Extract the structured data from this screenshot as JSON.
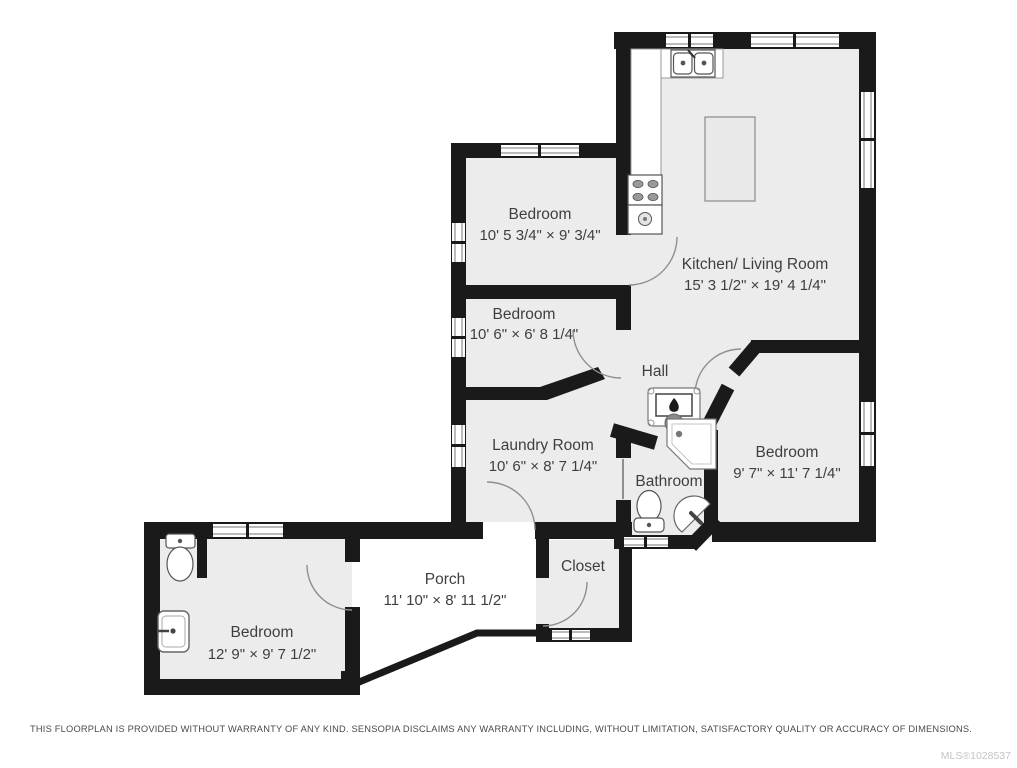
{
  "floorplan": {
    "rooms": [
      {
        "id": "bedroom-top-left",
        "name": "Bedroom",
        "dims": "10' 5 3/4\" × 9' 3/4\""
      },
      {
        "id": "kitchen-living-room",
        "name": "Kitchen/ Living Room",
        "dims": "15' 3 1/2\" × 19' 4 1/4\""
      },
      {
        "id": "bedroom-middle-left",
        "name": "Bedroom",
        "dims": "10' 6\" × 6' 8 1/4\""
      },
      {
        "id": "hall",
        "name": "Hall",
        "dims": ""
      },
      {
        "id": "laundry-room",
        "name": "Laundry Room",
        "dims": "10' 6\" × 8' 7 1/4\""
      },
      {
        "id": "bathroom",
        "name": "Bathroom",
        "dims": ""
      },
      {
        "id": "bedroom-right",
        "name": "Bedroom",
        "dims": "9' 7\" × 11' 7 1/4\""
      },
      {
        "id": "porch",
        "name": "Porch",
        "dims": "11' 10\" × 8' 11 1/2\""
      },
      {
        "id": "closet",
        "name": "Closet",
        "dims": ""
      },
      {
        "id": "bedroom-bottom-left",
        "name": "Bedroom",
        "dims": "12' 9\" × 9' 7 1/2\""
      }
    ],
    "fixtures": [
      "double-sink-icon",
      "stove-icon",
      "kitchen-island-icon",
      "furnace-icon",
      "corner-shower-icon",
      "toilet-icon",
      "corner-sink-icon",
      "toilet-icon",
      "vanity-sink-icon"
    ],
    "colors": {
      "wall": "#1a1a1a",
      "room_fill": "#ececec",
      "porch_fill": "#ffffff",
      "label": "#3f3f3f",
      "door_arc": "#8f8f8f"
    }
  },
  "footer": {
    "disclaimer": "THIS FLOORPLAN IS PROVIDED WITHOUT WARRANTY OF ANY KIND. SENSOPIA DISCLAIMS ANY WARRANTY INCLUDING, WITHOUT LIMITATION, SATISFACTORY QUALITY OR ACCURACY OF DIMENSIONS.",
    "mls": "MLS®1028537"
  }
}
